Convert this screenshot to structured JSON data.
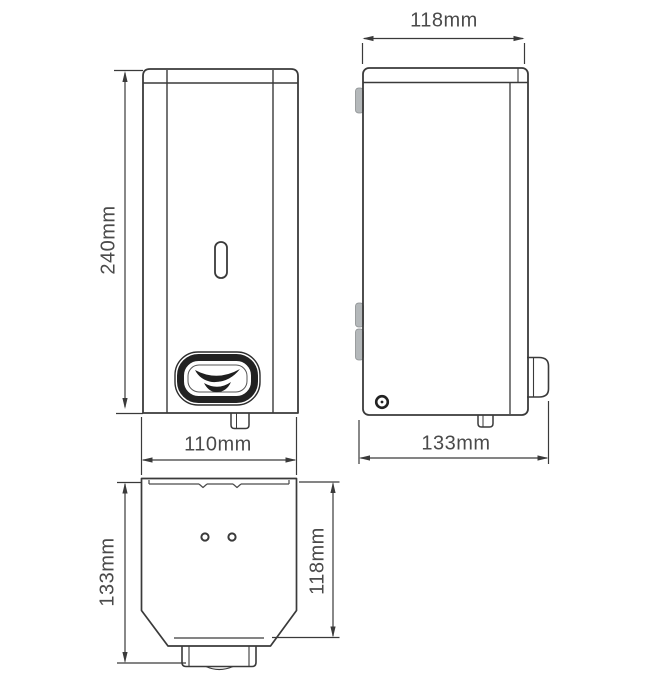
{
  "drawing": {
    "title": "soap dispenser dimension drawing",
    "views": [
      "front",
      "side",
      "plan"
    ]
  },
  "colors": {
    "background": "#ffffff",
    "line": "#3a3a3a",
    "text": "#4a4a4a",
    "tab_gray": "#b4b8ba",
    "glyph_black": "#1f1f1f"
  },
  "dimensions": {
    "front": {
      "height": "240mm",
      "width": "110mm"
    },
    "side": {
      "depth_top": "118mm",
      "depth_overall": "133mm"
    },
    "plan": {
      "depth_overall": "133mm",
      "depth_body": "118mm"
    }
  },
  "icons": {
    "dispense_arrows": "two curved press arrows on push button",
    "lock_screw": "lock screw on side panel"
  }
}
